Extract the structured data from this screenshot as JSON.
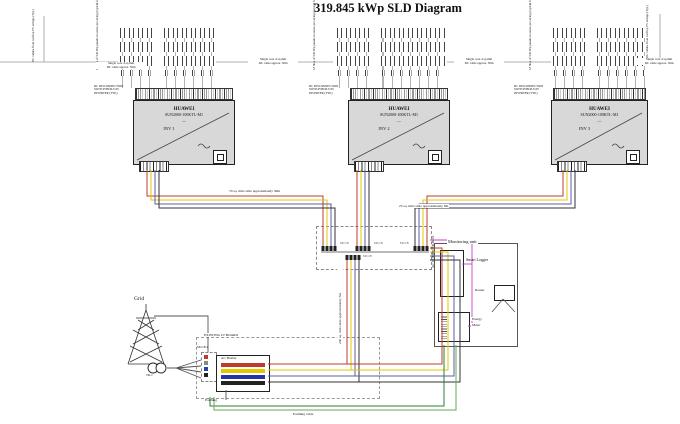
{
  "title": "319.845 kWp SLD Diagram",
  "strings_annotation": {
    "col1": "18 Nos of 545 Wp panels",
    "col2": "in series per string",
    "col3": "(typical for all strings)"
  },
  "edge_annotation": {
    "col1": "DC cables from rooftop",
    "col2": "PV strings (Typ.)"
  },
  "dc_route_label": {
    "line1": "Single core 4 sq.mm",
    "line2": "DC cable approx. 30m"
  },
  "dc_switch_note": {
    "line1": "DC DISCONNECTION",
    "line2": "SWITCH BUILT-IN",
    "line3": "INVERTER (TYP.)"
  },
  "inverters": [
    {
      "make": "HUAWEI",
      "model": "SUN2000-100KTL-M1",
      "symbol": "—",
      "name": "INV 1"
    },
    {
      "make": "HUAWEI",
      "model": "SUN2000-100KTL-M1",
      "symbol": "—",
      "name": "INV 2"
    },
    {
      "make": "HUAWEI",
      "model": "SUN2000-100KTL-M1",
      "symbol": "—",
      "name": "INV 3"
    }
  ],
  "cables": {
    "left": "70 sq. mm cable approximately 30m",
    "right": "25 sq. mm cable approximately 8m",
    "riser": "240 sq. mm cable approximately 5m",
    "earthing_run": "Earthing cable"
  },
  "combiner": {
    "label": "AC COMBINER BOX",
    "breaker1": "MCCB",
    "breaker2": "MCCB",
    "breaker3": "MCCB",
    "outgoing": "MCCB"
  },
  "monitoring": {
    "title": "Monitoring unit",
    "logger": "Smart Logger",
    "router": "Router",
    "meter_line1": "Energy",
    "meter_line2": "Meter"
  },
  "grid_section": {
    "grid": "Grid",
    "transformer": "TR-1",
    "breaker": "MCCB-1",
    "board": "EXISTING LT BOARD",
    "busbar": "AC Busbar",
    "earthing": "Earthing"
  },
  "colors": {
    "phase_r": "#c0392b",
    "phase_y": "#e3c800",
    "phase_b": "#5b5ea6",
    "neutral": "#333333",
    "earth": "#2e7d32",
    "earth_light": "#66aa55",
    "comm": "#cc3fcc",
    "inverter_fill": "#d8d8d8"
  }
}
